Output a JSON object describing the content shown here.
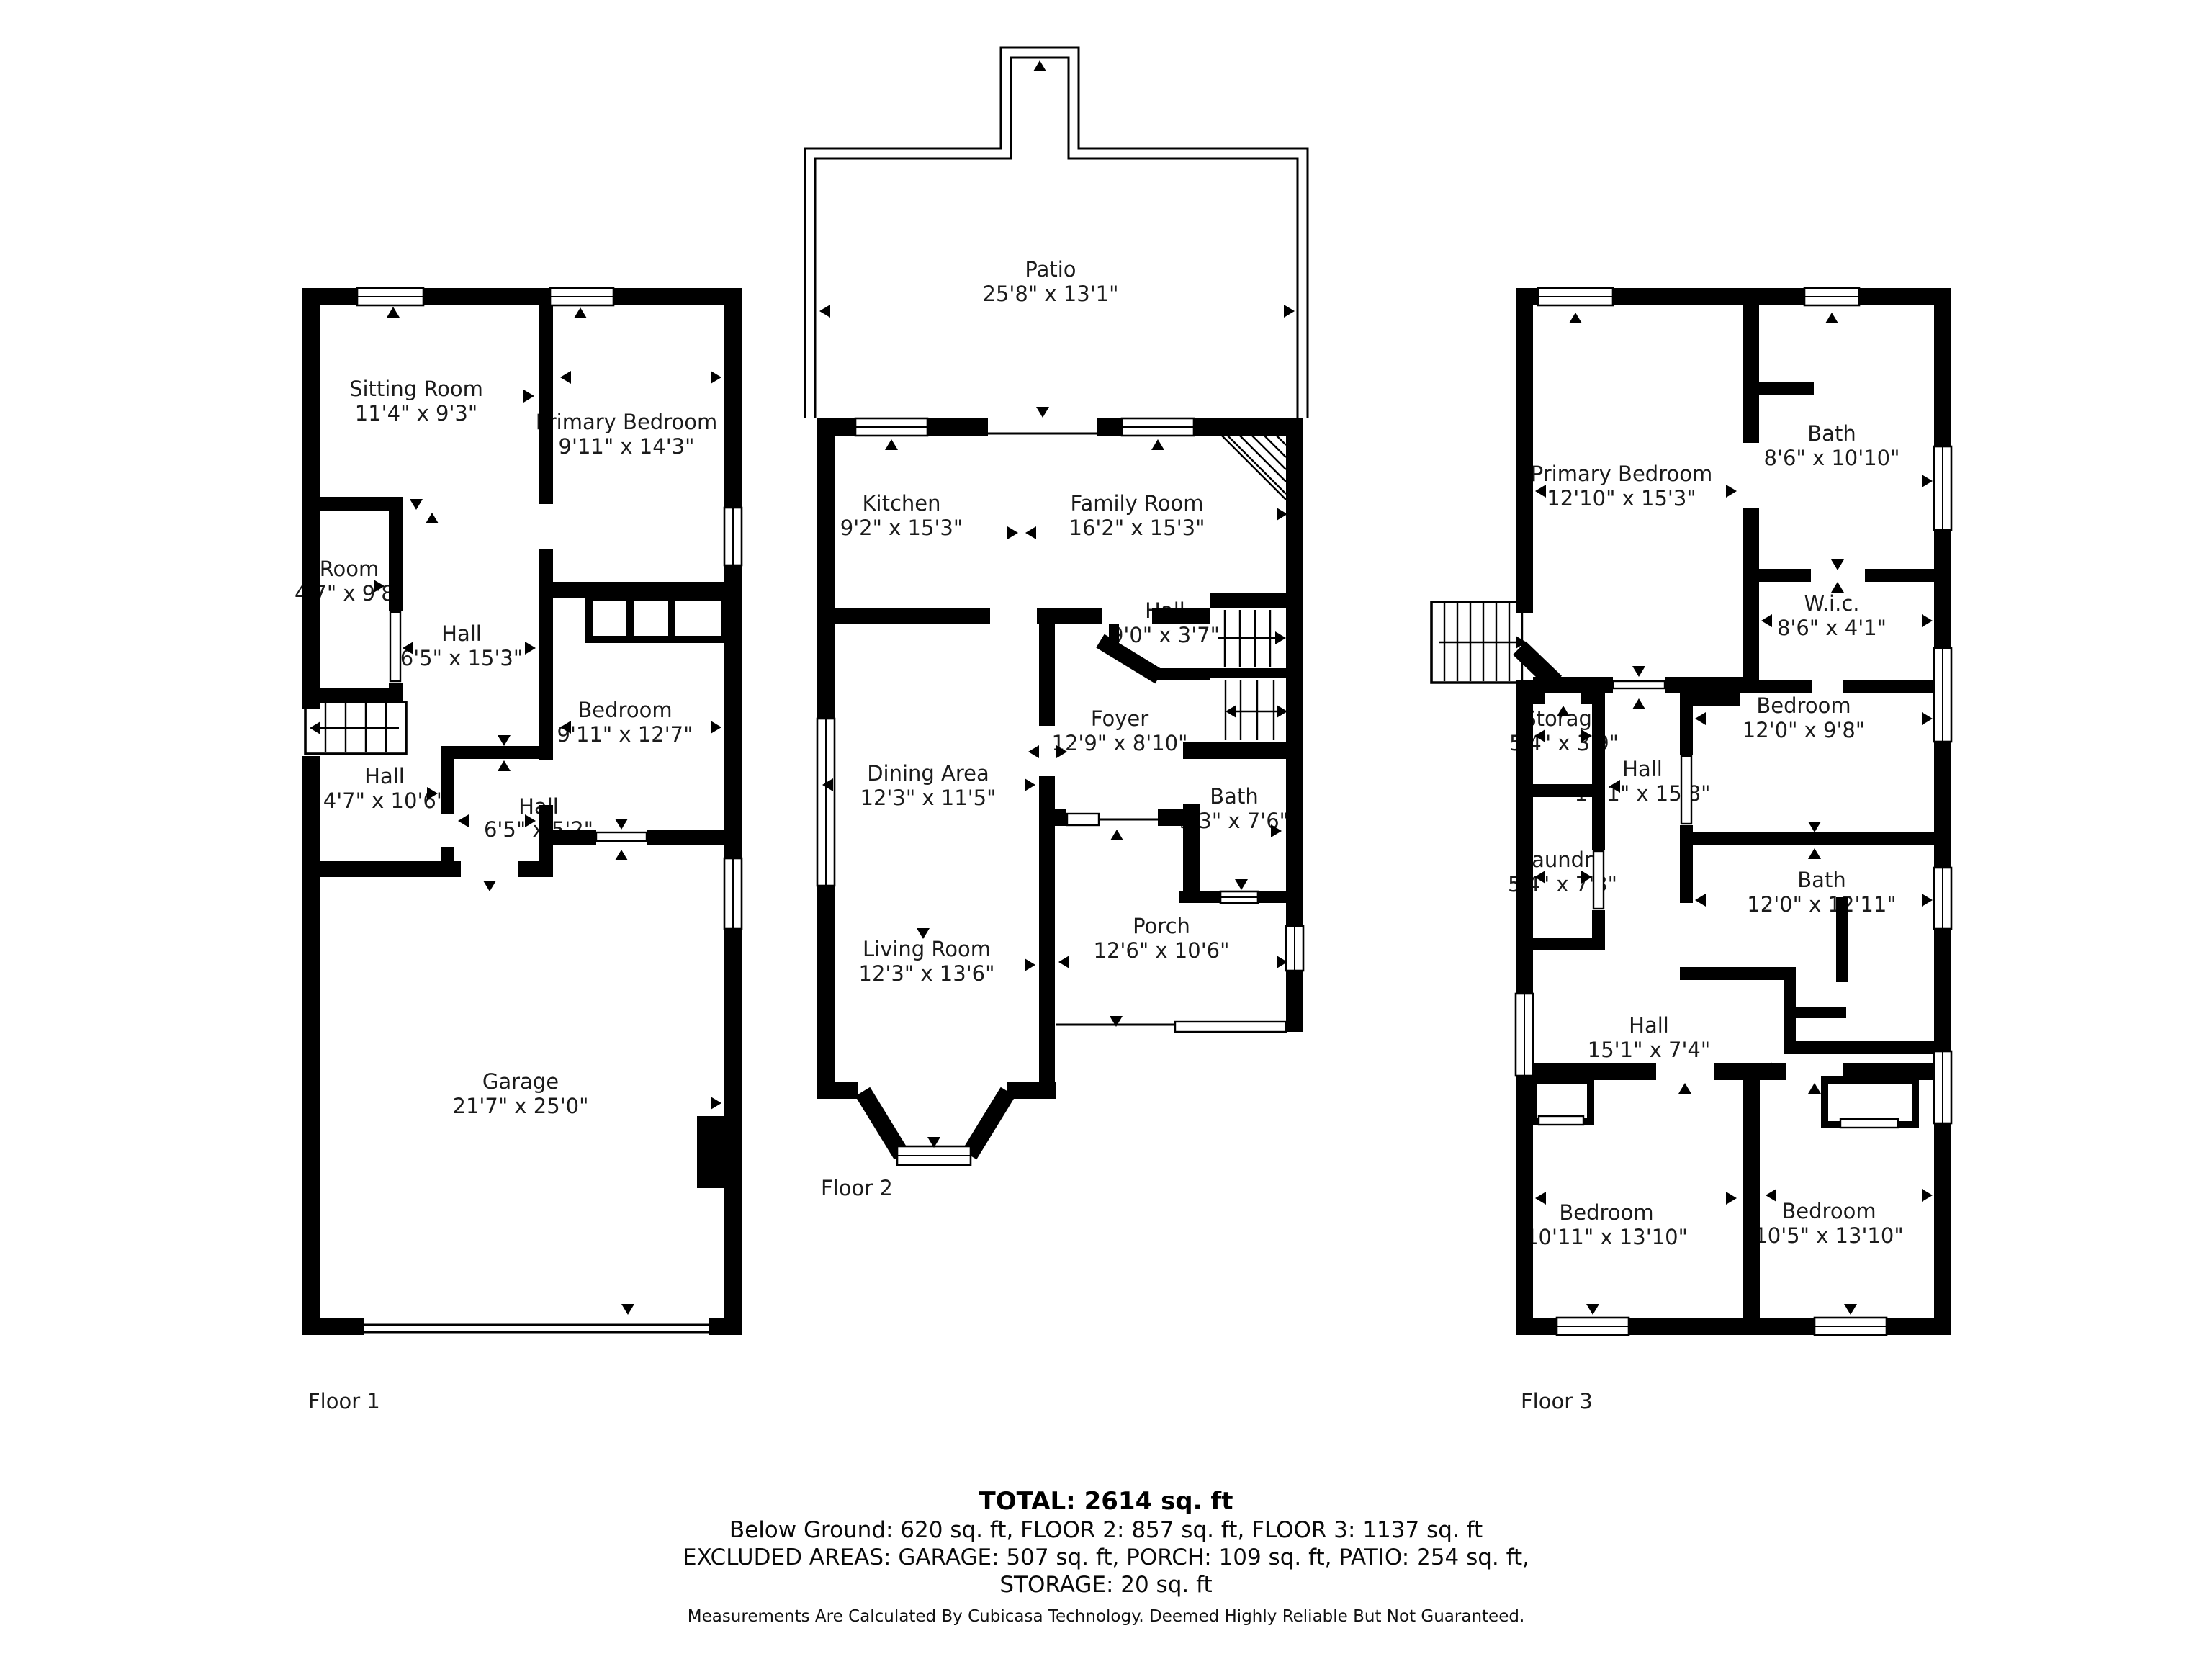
{
  "floors": [
    {
      "label": "Floor 1",
      "rooms": [
        {
          "name": "Sitting Room",
          "dims": "11'4\" x 9'3\""
        },
        {
          "name": "Primary Bedroom",
          "dims": "9'11\" x 14'3\""
        },
        {
          "name": "Room",
          "dims": "4'7\" x 9'8\""
        },
        {
          "name": "Hall",
          "dims": "6'5\" x 15'3\""
        },
        {
          "name": "Bedroom",
          "dims": "9'11\" x 12'7\""
        },
        {
          "name": "Hall",
          "dims": "4'7\" x 10'6\""
        },
        {
          "name": "Hall",
          "dims": "6'5\" x 5'2\""
        },
        {
          "name": "Garage",
          "dims": "21'7\" x 25'0\""
        }
      ]
    },
    {
      "label": "Floor 2",
      "rooms": [
        {
          "name": "Patio",
          "dims": "25'8\" x 13'1\""
        },
        {
          "name": "Kitchen",
          "dims": "9'2\" x 15'3\""
        },
        {
          "name": "Family Room",
          "dims": "16'2\" x 15'3\""
        },
        {
          "name": "Dining Area",
          "dims": "12'3\" x 11'5\""
        },
        {
          "name": "Hall",
          "dims": "9'0\" x 3'7\""
        },
        {
          "name": "Foyer",
          "dims": "12'9\" x 8'10\""
        },
        {
          "name": "Bath",
          "dims": "5'3\" x 7'6\""
        },
        {
          "name": "Living Room",
          "dims": "12'3\" x 13'6\""
        },
        {
          "name": "Porch",
          "dims": "12'6\" x 10'6\""
        }
      ]
    },
    {
      "label": "Floor 3",
      "rooms": [
        {
          "name": "Primary Bedroom",
          "dims": "12'10\" x 15'3\""
        },
        {
          "name": "Bath",
          "dims": "8'6\" x 10'10\""
        },
        {
          "name": "W.i.c.",
          "dims": "8'6\" x 4'1\""
        },
        {
          "name": "Storage",
          "dims": "5'4\" x 3'9\""
        },
        {
          "name": "Laundry",
          "dims": "5'4\" x 7'3\""
        },
        {
          "name": "Hall",
          "dims": "14'1\" x 15'8\""
        },
        {
          "name": "Bedroom",
          "dims": "12'0\" x 9'8\""
        },
        {
          "name": "Bath",
          "dims": "12'0\" x 12'11\""
        },
        {
          "name": "Hall",
          "dims": "15'1\" x 7'4\""
        },
        {
          "name": "Bedroom",
          "dims": "10'11\" x 13'10\""
        },
        {
          "name": "Bedroom",
          "dims": "10'5\" x 13'10\""
        }
      ]
    }
  ],
  "summary": {
    "total": "TOTAL: 2614 sq. ft",
    "breakdown": "Below Ground: 620 sq. ft, FLOOR 2: 857 sq. ft, FLOOR 3: 1137 sq. ft",
    "excluded": "EXCLUDED AREAS: GARAGE: 507 sq. ft, PORCH: 109 sq. ft, PATIO: 254 sq. ft,",
    "excluded2": "STORAGE: 20 sq. ft"
  },
  "disclaimer": "Measurements Are Calculated By Cubicasa Technology. Deemed Highly Reliable But Not Guaranteed."
}
